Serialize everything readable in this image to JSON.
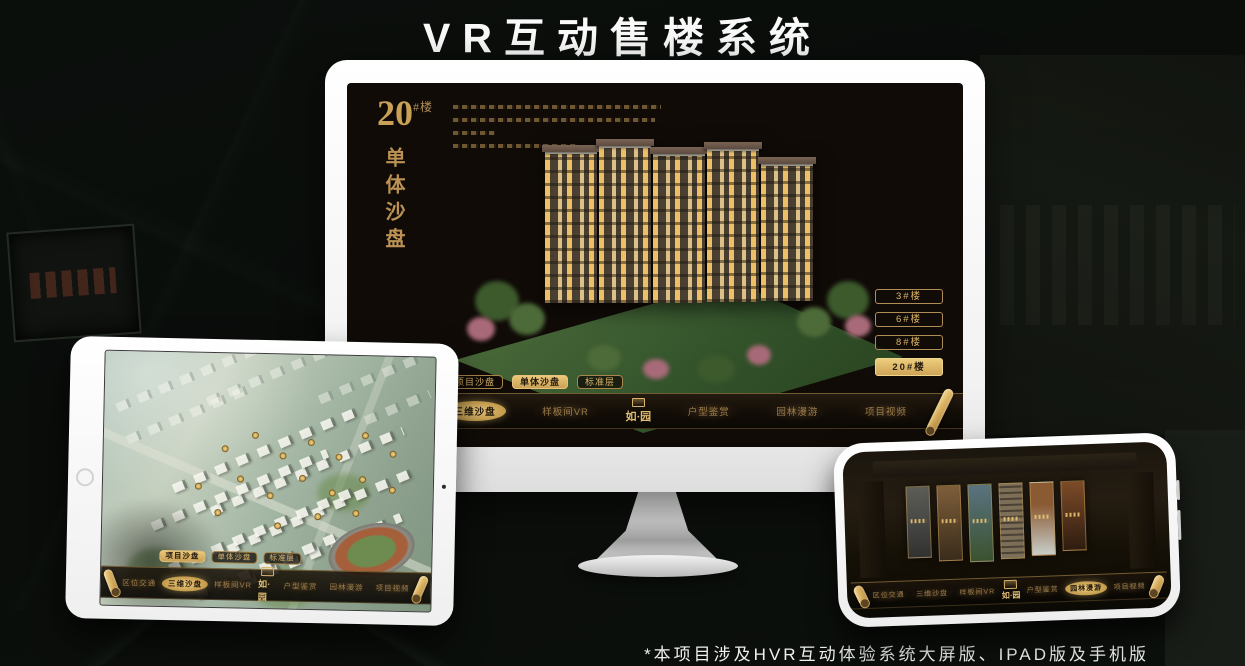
{
  "page": {
    "title": "VR互动售楼系统",
    "footnote": "*本项目涉及HVR互动体验系统大屏版、IPAD版及手机版"
  },
  "monitor": {
    "heading": {
      "number": "20",
      "suffix": "#楼",
      "vertical": "单体沙盘"
    },
    "floor_buttons": [
      {
        "label": "3#楼",
        "selected": false
      },
      {
        "label": "6#楼",
        "selected": false
      },
      {
        "label": "8#楼",
        "selected": false
      },
      {
        "label": "20#楼",
        "selected": true
      }
    ],
    "sub_tabs": [
      {
        "label": "项目沙盘",
        "selected": false
      },
      {
        "label": "单体沙盘",
        "selected": true
      },
      {
        "label": "标准层",
        "selected": false
      }
    ],
    "nav_items": [
      {
        "label": "区位交通",
        "selected": false
      },
      {
        "label": "三维沙盘",
        "selected": true
      },
      {
        "label": "样板间VR",
        "selected": false
      },
      {
        "label": "户型鉴赏",
        "selected": false
      },
      {
        "label": "园林漫游",
        "selected": false
      },
      {
        "label": "项目视频",
        "selected": false
      }
    ],
    "logo": "如·园"
  },
  "tablet": {
    "sub_tabs": [
      {
        "label": "项目沙盘",
        "selected": true
      },
      {
        "label": "单体沙盘",
        "selected": false
      },
      {
        "label": "标准层",
        "selected": false
      }
    ],
    "nav_items": [
      {
        "label": "区位交通",
        "selected": false
      },
      {
        "label": "三维沙盘",
        "selected": true
      },
      {
        "label": "样板间VR",
        "selected": false
      },
      {
        "label": "户型鉴赏",
        "selected": false
      },
      {
        "label": "园林漫游",
        "selected": false
      },
      {
        "label": "项目视频",
        "selected": false
      }
    ],
    "logo": "如·园"
  },
  "phone": {
    "nav_items": [
      {
        "label": "区位交通",
        "selected": false
      },
      {
        "label": "三维沙盘",
        "selected": false
      },
      {
        "label": "样板间VR",
        "selected": false
      },
      {
        "label": "户型鉴赏",
        "selected": false
      },
      {
        "label": "园林漫游",
        "selected": true
      },
      {
        "label": "项目视频",
        "selected": false
      }
    ],
    "logo": "如·园"
  },
  "colors": {
    "gold": "#c9a156",
    "gold_bright": "#ecca80",
    "screen_bg": "#100b07"
  }
}
